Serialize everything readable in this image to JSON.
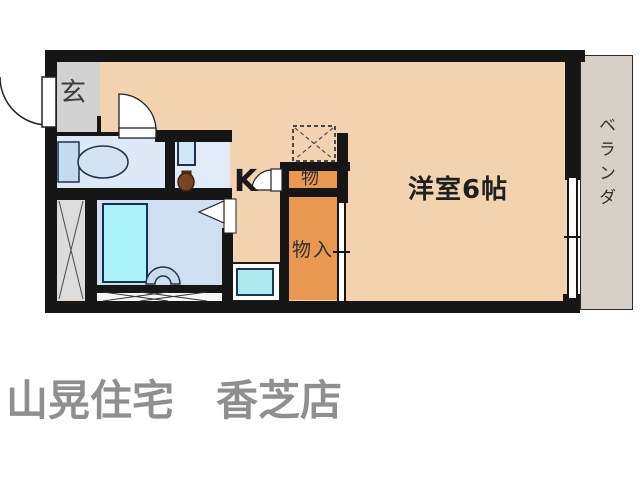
{
  "floorplan": {
    "labels": {
      "entrance": "玄",
      "kitchen": "K",
      "upper_storage": "物",
      "closet": "物入",
      "western_room": "洋室6帖",
      "balcony": "ベランダ"
    },
    "footer_text": "山晃住宅　香芝店",
    "colors": {
      "wall": "#161616",
      "main_floor": "#f3d2b0",
      "closet_orange": "#e99851",
      "entrance_gray": "#d2d2d2",
      "balcony_gray": "#d6d0c9",
      "toilet_floor": "#dde9f6",
      "washroom_floor": "#e2ecf8",
      "bathroom_floor": "#cddff0",
      "bathtub_fill": "#abf1fa",
      "sink_fill": "#aee9f0",
      "duct_gray": "#dcdcdc",
      "footer_text_color": "#8f8f8f"
    }
  }
}
